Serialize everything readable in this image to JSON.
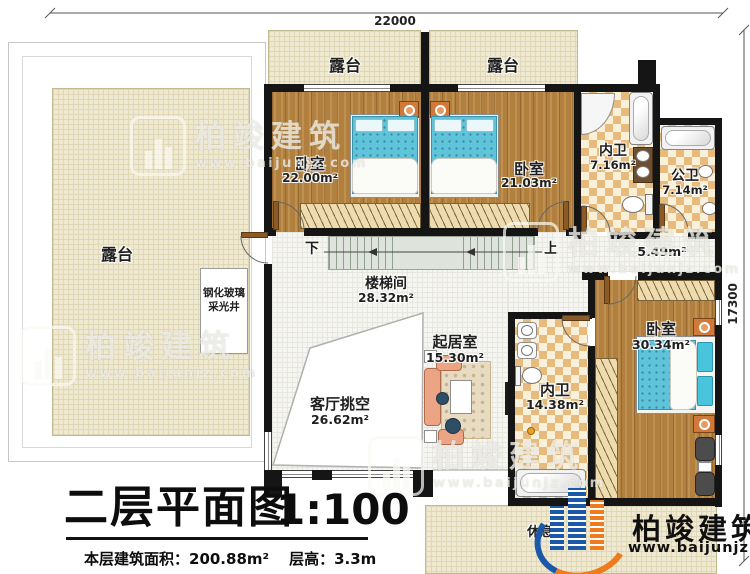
{
  "colors": {
    "brand_blue": "#1b59a8",
    "brand_orange": "#ee7b1d",
    "wall": "#151515",
    "wood_floor": "#b2803e",
    "terrace_cream": "#efe9d1",
    "bath_tile_tan": "#e6bb7d",
    "bed_blue": "#5fc3da"
  },
  "dimensions": {
    "top": "22000",
    "right": "17300"
  },
  "stairs": {
    "down": "下",
    "up": "上"
  },
  "rooms": {
    "terrace_left": {
      "label": "露台"
    },
    "terrace_top_left": {
      "label": "露台"
    },
    "terrace_top_right": {
      "label": "露台"
    },
    "bedroom_top_left": {
      "label": "卧室",
      "area": "22.00m²"
    },
    "bedroom_top_right": {
      "label": "卧室",
      "area": "21.03m²"
    },
    "ensuite_bath_top": {
      "label": "内卫",
      "area": "7.16m²"
    },
    "public_bath": {
      "label": "公卫",
      "area": "7.14m²"
    },
    "hallway": {
      "area": "5.49m²"
    },
    "stairwell": {
      "label": "楼梯间",
      "area": "28.32m²"
    },
    "living_room": {
      "label": "起居室",
      "area": "15.30m²"
    },
    "living_void": {
      "label": "客厅挑空",
      "area": "26.62m²"
    },
    "ensuite_bath_master": {
      "label": "内卫",
      "area": "14.38m²"
    },
    "master_bedroom": {
      "label": "卧室",
      "area": "30.34m²"
    },
    "lightwell": {
      "line1": "钢化玻璃",
      "line2": "采光井"
    },
    "rest_area": {
      "label": "休息"
    }
  },
  "branding": {
    "name": "柏竣建筑",
    "url": "www.baijunjz.com"
  },
  "title_block": {
    "title": "二层平面图",
    "scale": "1:100",
    "area_text": "本层建筑面积：200.88m²",
    "height_text": "层高：3.3m"
  }
}
